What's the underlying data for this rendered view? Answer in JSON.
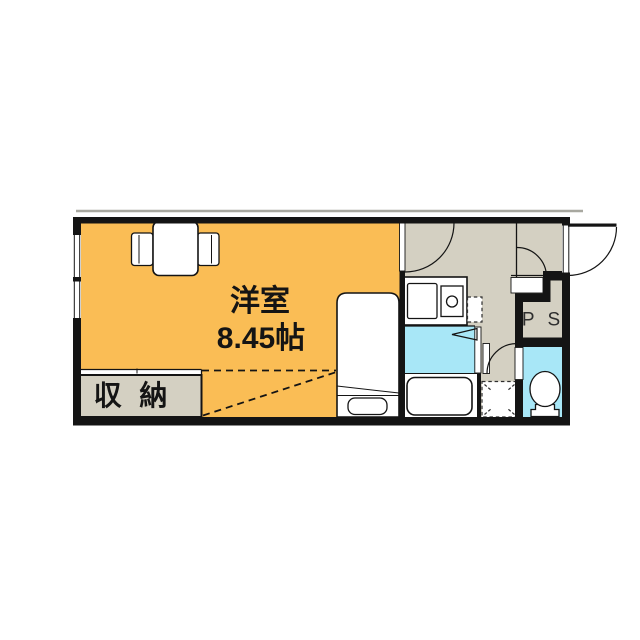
{
  "floorplan": {
    "main_room": {
      "name_label": "洋室",
      "size_label": "8.45帖"
    },
    "closet": {
      "label": "収 納"
    },
    "pipe_space": {
      "label": "P S"
    },
    "colors": {
      "room_orange": "#FABD55",
      "service_gray": "#D4D0C2",
      "wet_area_cyan": "#A8E7F7",
      "wall_black": "#141414",
      "fixture_white": "#FFFFFF",
      "balcony_line_gray": "#A8A8A0"
    }
  }
}
